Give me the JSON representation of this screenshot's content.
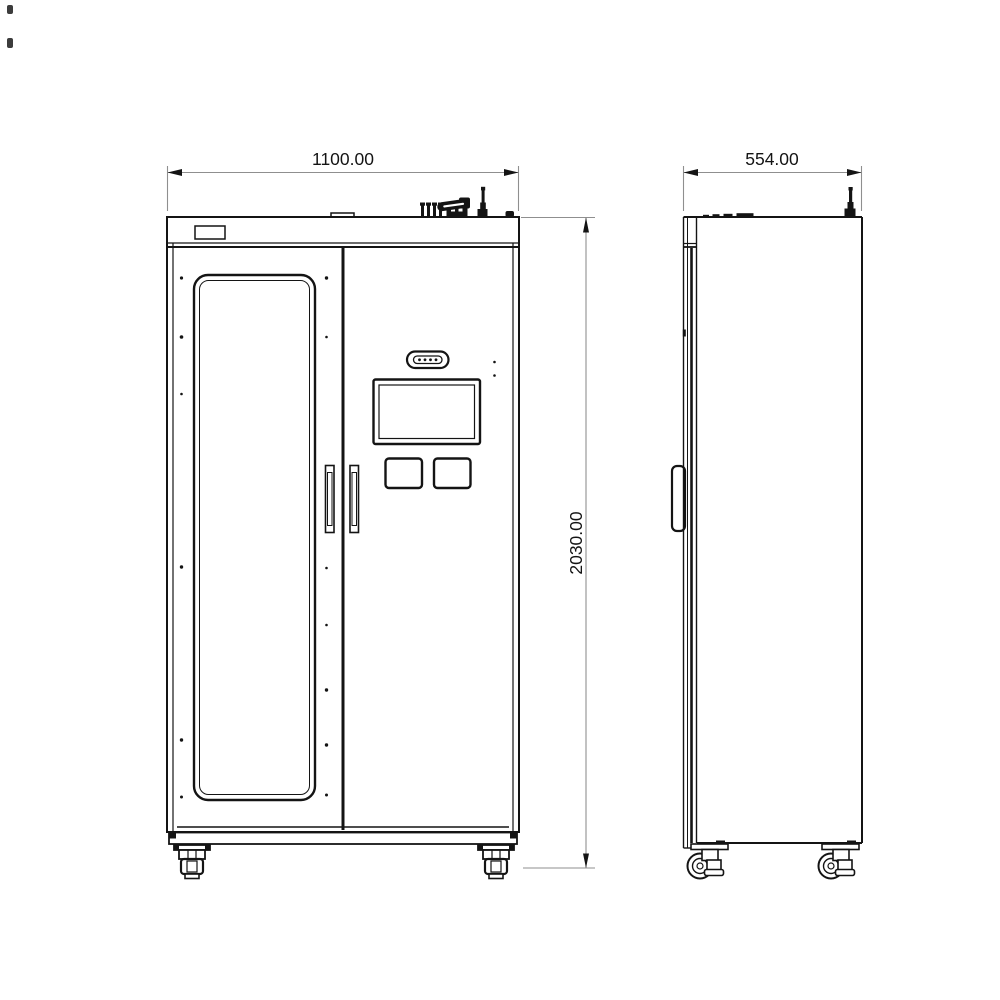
{
  "dimensions": {
    "width_label": "1100.00",
    "depth_label": "554.00",
    "height_label": "2030.00"
  },
  "colors": {
    "line": "#141414",
    "dim": "#8f8f8f",
    "text": "#141414",
    "background": "#ffffff"
  }
}
